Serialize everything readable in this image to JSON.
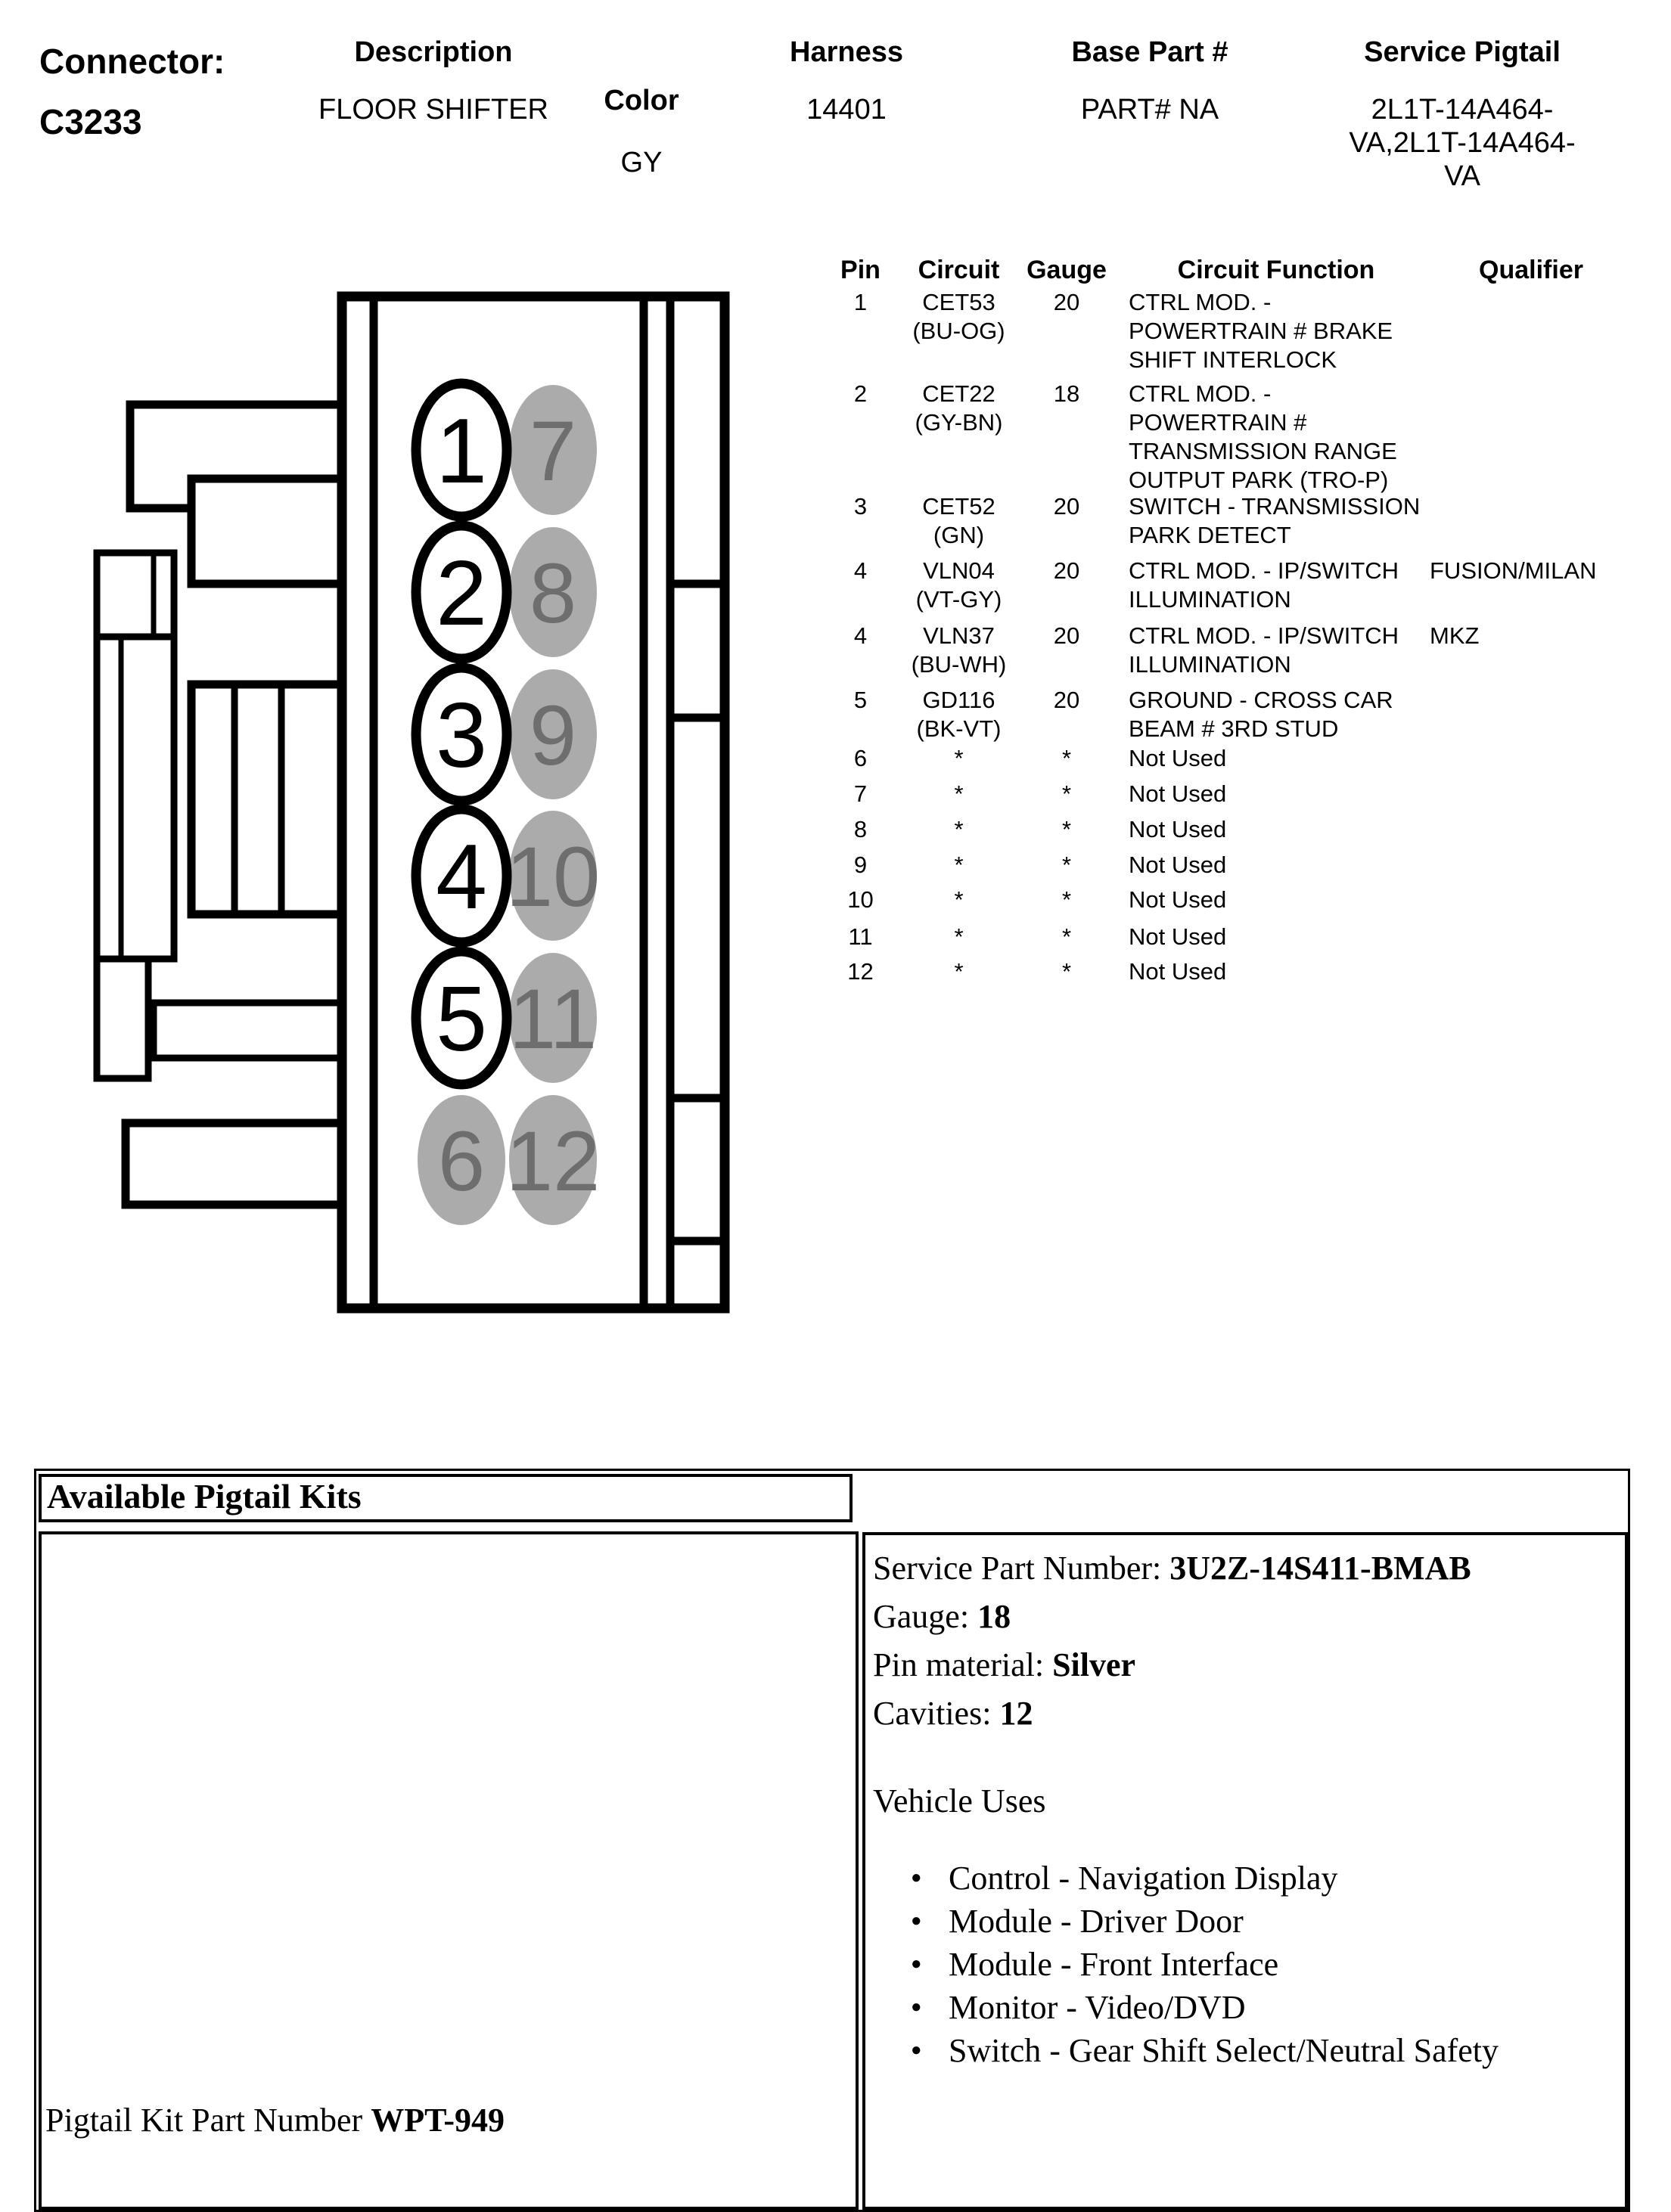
{
  "header": {
    "connector_label": "Connector:",
    "connector_id": "C3233",
    "description_label": "Description",
    "description_value": "FLOOR SHIFTER",
    "color_label": "Color",
    "color_value": "GY",
    "harness_label": "Harness",
    "harness_value": "14401",
    "base_part_label": "Base Part #",
    "base_part_value": "PART# NA",
    "service_pigtail_label": "Service Pigtail",
    "service_pigtail_line1": "2L1T-14A464-",
    "service_pigtail_line2": "VA,2L1T-14A464-",
    "service_pigtail_line3": "VA"
  },
  "pin_table": {
    "columns": {
      "pin": "Pin",
      "circuit": "Circuit",
      "gauge": "Gauge",
      "function": "Circuit Function",
      "qualifier": "Qualifier"
    },
    "rows": [
      {
        "pin": "1",
        "c1": "CET53",
        "c2": "(BU-OG)",
        "g": "20",
        "f1": "CTRL MOD. -",
        "f2": "POWERTRAIN # BRAKE",
        "f3": "SHIFT INTERLOCK"
      },
      {
        "pin": "2",
        "c1": "CET22",
        "c2": "(GY-BN)",
        "g": "18",
        "f1": "CTRL MOD. -",
        "f2": "POWERTRAIN #",
        "f3": "TRANSMISSION RANGE",
        "f4": "OUTPUT PARK (TRO-P)"
      },
      {
        "pin": "3",
        "c1": "CET52",
        "c2": "(GN)",
        "g": "20",
        "f1": "SWITCH - TRANSMISSION",
        "f2": "PARK DETECT"
      },
      {
        "pin": "4",
        "c1": "VLN04",
        "c2": "(VT-GY)",
        "g": "20",
        "f1": "CTRL MOD. - IP/SWITCH",
        "f2": "ILLUMINATION",
        "q": "FUSION/MILAN"
      },
      {
        "pin": "4",
        "c1": "VLN37",
        "c2": "(BU-WH)",
        "g": "20",
        "f1": "CTRL MOD. - IP/SWITCH",
        "f2": "ILLUMINATION",
        "q": "MKZ"
      },
      {
        "pin": "5",
        "c1": "GD116",
        "c2": "(BK-VT)",
        "g": "20",
        "f1": "GROUND - CROSS CAR",
        "f2": "BEAM # 3RD STUD"
      },
      {
        "pin": "6",
        "c1": "*",
        "g": "*",
        "f1": "Not Used"
      },
      {
        "pin": "7",
        "c1": "*",
        "g": "*",
        "f1": "Not Used"
      },
      {
        "pin": "8",
        "c1": "*",
        "g": "*",
        "f1": "Not Used"
      },
      {
        "pin": "9",
        "c1": "*",
        "g": "*",
        "f1": "Not Used"
      },
      {
        "pin": "10",
        "c1": "*",
        "g": "*",
        "f1": "Not Used"
      },
      {
        "pin": "11",
        "c1": "*",
        "g": "*",
        "f1": "Not Used"
      },
      {
        "pin": "12",
        "c1": "*",
        "g": "*",
        "f1": "Not Used"
      }
    ]
  },
  "diagram": {
    "pins": [
      {
        "n": "1",
        "used": true
      },
      {
        "n": "2",
        "used": true
      },
      {
        "n": "3",
        "used": true
      },
      {
        "n": "4",
        "used": true
      },
      {
        "n": "5",
        "used": true
      },
      {
        "n": "6",
        "used": false
      },
      {
        "n": "7",
        "used": false
      },
      {
        "n": "8",
        "used": false
      },
      {
        "n": "9",
        "used": false
      },
      {
        "n": "10",
        "used": false
      },
      {
        "n": "11",
        "used": false
      },
      {
        "n": "12",
        "used": false
      }
    ],
    "unused_pin_fill": "#ABABAB",
    "unused_pin_text": "#6E6E6E",
    "used_pin_fill": "#FFFFFF",
    "used_pin_text": "#000000"
  },
  "pigtail": {
    "title": "Available Pigtail Kits",
    "service_part_label": "Service Part Number: ",
    "service_part_value": "3U2Z-14S411-BMAB",
    "gauge_label": "Gauge: ",
    "gauge_value": "18",
    "pin_material_label": "Pin material: ",
    "pin_material_value": "Silver",
    "cavities_label": "Cavities: ",
    "cavities_value": "12",
    "vehicle_uses_label": "Vehicle Uses",
    "vehicle_uses": [
      "Control - Navigation Display",
      "Module - Driver Door",
      "Module - Front Interface",
      "Monitor - Video/DVD",
      "Switch - Gear Shift Select/Neutral Safety"
    ],
    "kit_label": "Pigtail Kit Part Number ",
    "kit_value": "WPT-949"
  }
}
